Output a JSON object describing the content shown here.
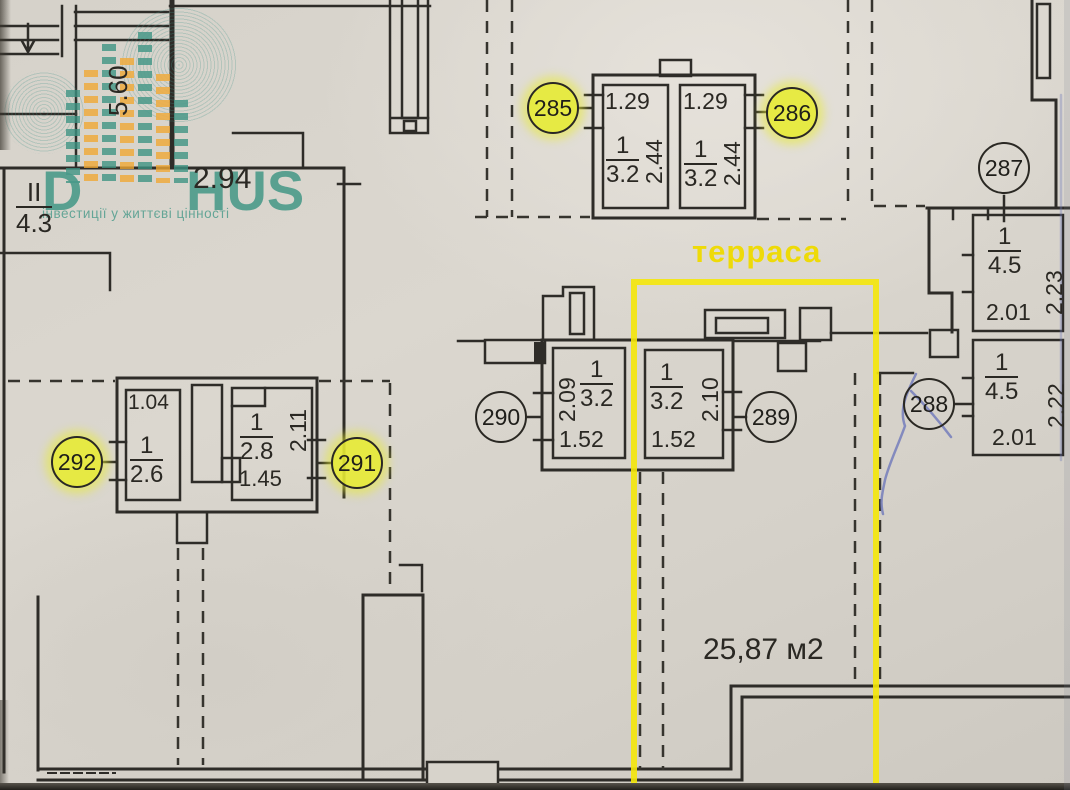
{
  "watermark": {
    "brand_first": "D",
    "brand_rest": "HUS",
    "tagline": "інвестиції у життєві цінності"
  },
  "terrace": {
    "label": "терраса",
    "area": "25,87 м2"
  },
  "stairs": {
    "level": "II",
    "area": "4.3",
    "width": "2.94",
    "depth": "5.60"
  },
  "circles": [
    {
      "label": "285",
      "highlight": true
    },
    {
      "label": "286",
      "highlight": true
    },
    {
      "label": "287",
      "highlight": false
    },
    {
      "label": "288",
      "highlight": false
    },
    {
      "label": "289",
      "highlight": false
    },
    {
      "label": "290",
      "highlight": false
    },
    {
      "label": "291",
      "highlight": true
    },
    {
      "label": "292",
      "highlight": true
    }
  ],
  "rooms": {
    "r285": {
      "w": "1.29",
      "h": "2.44",
      "num": "1",
      "den": "3.2"
    },
    "r286": {
      "w": "1.29",
      "h": "2.44",
      "num": "1",
      "den": "3.2"
    },
    "r290": {
      "h": "2.09",
      "w": "1.52",
      "num": "1",
      "den": "3.2"
    },
    "r289": {
      "h": "2.10",
      "w": "1.52",
      "num": "1",
      "den": "3.2"
    },
    "r292": {
      "w": "1.04",
      "num": "1",
      "den": "2.6"
    },
    "r291": {
      "h": "2.11",
      "w": "1.45",
      "num": "1",
      "den": "2.8"
    },
    "r287": {
      "w": "2.01",
      "h": "2.23",
      "num": "1",
      "den": "4.5"
    },
    "r288": {
      "w": "2.01",
      "h": "2.22",
      "num": "1",
      "den": "4.5"
    }
  },
  "colors": {
    "highlight_yellow": "#e7eb34",
    "terrace_border": "#f4e70a",
    "terrace_label": "#eeda08",
    "brand_teal": "#2e8f7d",
    "brand_orange": "#f0a832",
    "line": "#2e2c28"
  }
}
